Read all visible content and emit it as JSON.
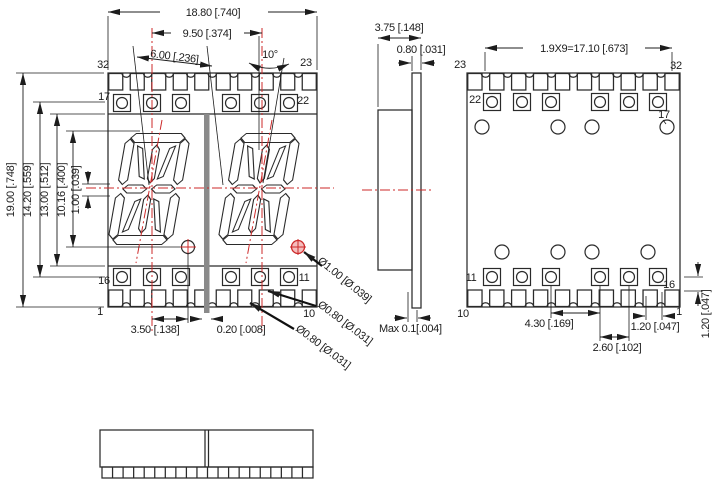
{
  "drawing_title": "Dual 14-segment alphanumeric SMD display package drawing",
  "colors": {
    "line": "#2a2a2a",
    "dimension": "#1c1c1c",
    "centerline_red": "#cc2a2a",
    "dp_fill_pink": "#f5bdbd",
    "divider_gray": "#8a8a8a",
    "background": "#ffffff"
  },
  "front": {
    "pins": {
      "p32": "32",
      "p23": "23",
      "p17": "17",
      "p22": "22",
      "p16": "16",
      "p11": "11",
      "p1": "1",
      "p10": "10"
    },
    "dims": {
      "width": "18.80 [.740]",
      "pitch": "9.50 [.374]",
      "char_w": "6.00 [.236]",
      "slant": "10°",
      "height": "19.00 [.748]",
      "pad_span": "14.20 [.559]",
      "face_h": "13.00 [.512]",
      "char_h": "10.16 [.400]",
      "mid_gap": "1.00 [.039]",
      "dp_off": "3.50 [.138]",
      "center_gap": "0.20 [.008]",
      "dp_dia": "Ø1.00 [Ø.039]",
      "pad_dia": "Ø0.80 [Ø.031]",
      "notch_dia": "Ø0.80 [Ø.031]"
    }
  },
  "side": {
    "dims": {
      "depth": "3.75 [.148]",
      "pcb": "0.80 [.031]",
      "flat": "Max 0.1[.004]"
    }
  },
  "back": {
    "pins": {
      "p23": "23",
      "p32": "32",
      "p22": "22",
      "p17": "17",
      "p11": "11",
      "p16": "16",
      "p10": "10",
      "p1": "1"
    },
    "dims": {
      "pitch_total": "1.9X9=17.10 [.673]",
      "via_span": "4.30 [.169]",
      "via_off": "2.60 [.102]",
      "edge": "1.20 [.047]",
      "edge_v": "1.20 [.047]"
    }
  }
}
